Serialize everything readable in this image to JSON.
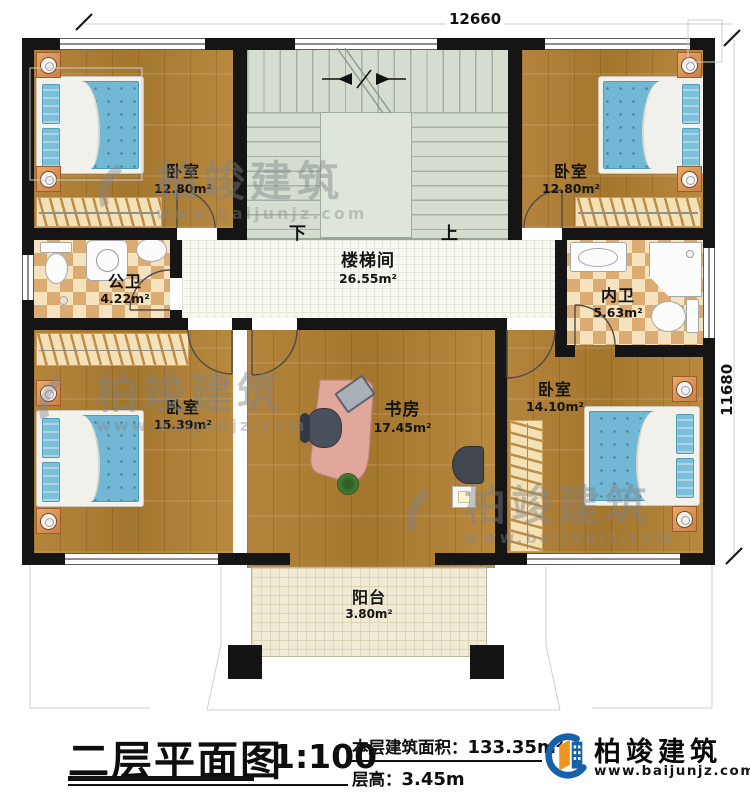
{
  "plan": {
    "dim_top": "12660",
    "dim_right": "11680",
    "stairs": {
      "down": "下",
      "up": "上"
    },
    "rooms": {
      "bedroom_tl": {
        "name": "卧室",
        "area": "12.80m²"
      },
      "bedroom_tr": {
        "name": "卧室",
        "area": "12.80m²"
      },
      "stairhall": {
        "name": "楼梯间",
        "area": "26.55m²"
      },
      "bath_public": {
        "name": "公卫",
        "area": "4.22m²"
      },
      "bath_master": {
        "name": "内卫",
        "area": "5.63m²"
      },
      "bedroom_bl": {
        "name": "卧室",
        "area": "15.39m²"
      },
      "study": {
        "name": "书房",
        "area": "17.45m²"
      },
      "bedroom_br": {
        "name": "卧室",
        "area": "14.10m²"
      },
      "balcony": {
        "name": "阳台",
        "area": "3.80m²"
      }
    }
  },
  "titlebar": {
    "title": "二层平面图",
    "scale": "1:100",
    "area_label": "本层建筑面积：",
    "area_value": "133.35m²",
    "height_label": "层高：",
    "height_value": "3.45m"
  },
  "brand": {
    "name": "柏竣建筑",
    "site": "www.baijunjz.com"
  },
  "watermark": {
    "name": "柏竣建筑",
    "site": "www.baijunjz.com"
  },
  "colors": {
    "wall": "#151515",
    "wood": "#b0803a",
    "stair": "#d4ddd0",
    "tile": "#f8f8f2",
    "checker_light": "#f5e3c0",
    "checker_dark": "#dcab71",
    "balcony": "#f0ead6",
    "mattress": "#72b7d3",
    "desk": "#e2a79b",
    "logo_blue": "#1761a8",
    "logo_orange": "#f0941d"
  }
}
